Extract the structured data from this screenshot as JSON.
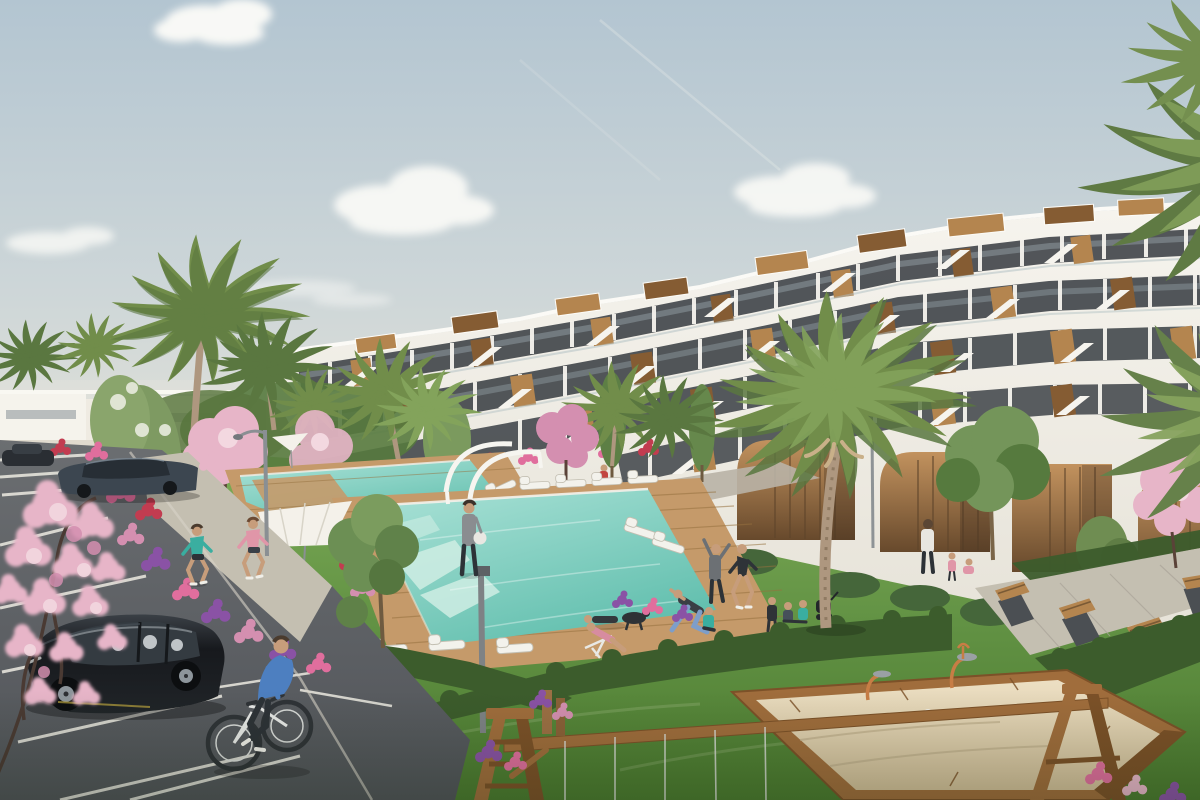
{
  "meta": {
    "type": "architectural-render",
    "description": "Sunny 3D architectural rendering of a white terraced apartment complex with wood accents, two turquoise swimming pools with timber decks and white sun loungers, palm trees and pink cherry blossoms, lawns with people exercising and relaxing, a parking lot with dark cars and a cyclist, and a children's playground with a sandbox and wooden swing frame.",
    "width": 1200,
    "height": 800
  },
  "palette": {
    "sky-top": "#b3c5d1",
    "sky-mid": "#cdd6d8",
    "sky-horizon": "#e7e4d8",
    "cloud": "#fafaf7",
    "bldg-light": "#f6f4ee",
    "bldg-shade": "#e4e0d5",
    "glass": "#43484c",
    "glass-lite": "#93a0a5",
    "wood": "#b4854f",
    "wood-dark": "#855c33",
    "arch-tan": "#c2925e",
    "arch-dark": "#67492c",
    "palm": "#718d4a",
    "palm-dark": "#5a7740",
    "palm-lite": "#83a35b",
    "tree": "#74955a",
    "tree-dark": "#567a3e",
    "grass-hi": "#7fae58",
    "grass": "#629244",
    "grass-lo": "#4b7a2f",
    "hedge": "#3c5c2c",
    "pool-hi": "#abe2d7",
    "pool": "#62bfae",
    "deck": "#c59a6a",
    "deck-dark": "#916940",
    "sand": "#ecdfc3",
    "sand-sh": "#d3bf99",
    "asphalt": "#6b6e71",
    "asphalt-dk": "#515459",
    "path": "#c4bfb1",
    "mark": "#edebe2",
    "blossom": "#e7b5c8",
    "blossom-dk": "#d48fb0",
    "blossom-li": "#f3d8e0",
    "fl-red": "#c23c50",
    "fl-pink": "#e06e9d",
    "fl-purple": "#8a52a5",
    "car-body": "#17191d",
    "car-glass": "#343b41",
    "metal": "#9aa0a4",
    "skin": "#c79d7b",
    "dark": "#2d3237",
    "teal": "#3aaea0",
    "blue": "#4d7fc0",
    "pink": "#e096a8",
    "red": "#c2453f",
    "jeans": "#7e9ec9",
    "gray": "#898c8f",
    "white": "#f6f5f0",
    "trunk": "#ae977f",
    "rope": "#d6d9d3",
    "wood-play": "#a06d3c",
    "wood-play-dk": "#7c5128"
  },
  "scene": {
    "sky": {
      "clouds": 6
    },
    "buildings": {
      "main": "terraced-apartment-block",
      "background": "low-rise-clubhouse"
    },
    "pools": 2,
    "parasols": 2,
    "sun_loungers": 12,
    "benches": 4,
    "vehicles": {
      "cars": 3,
      "bicycles": 1
    },
    "people": 16,
    "palm_trees": 12,
    "blossom_trees": 5,
    "playground": [
      "sandbox",
      "swing-frame",
      "spring-toys"
    ]
  }
}
